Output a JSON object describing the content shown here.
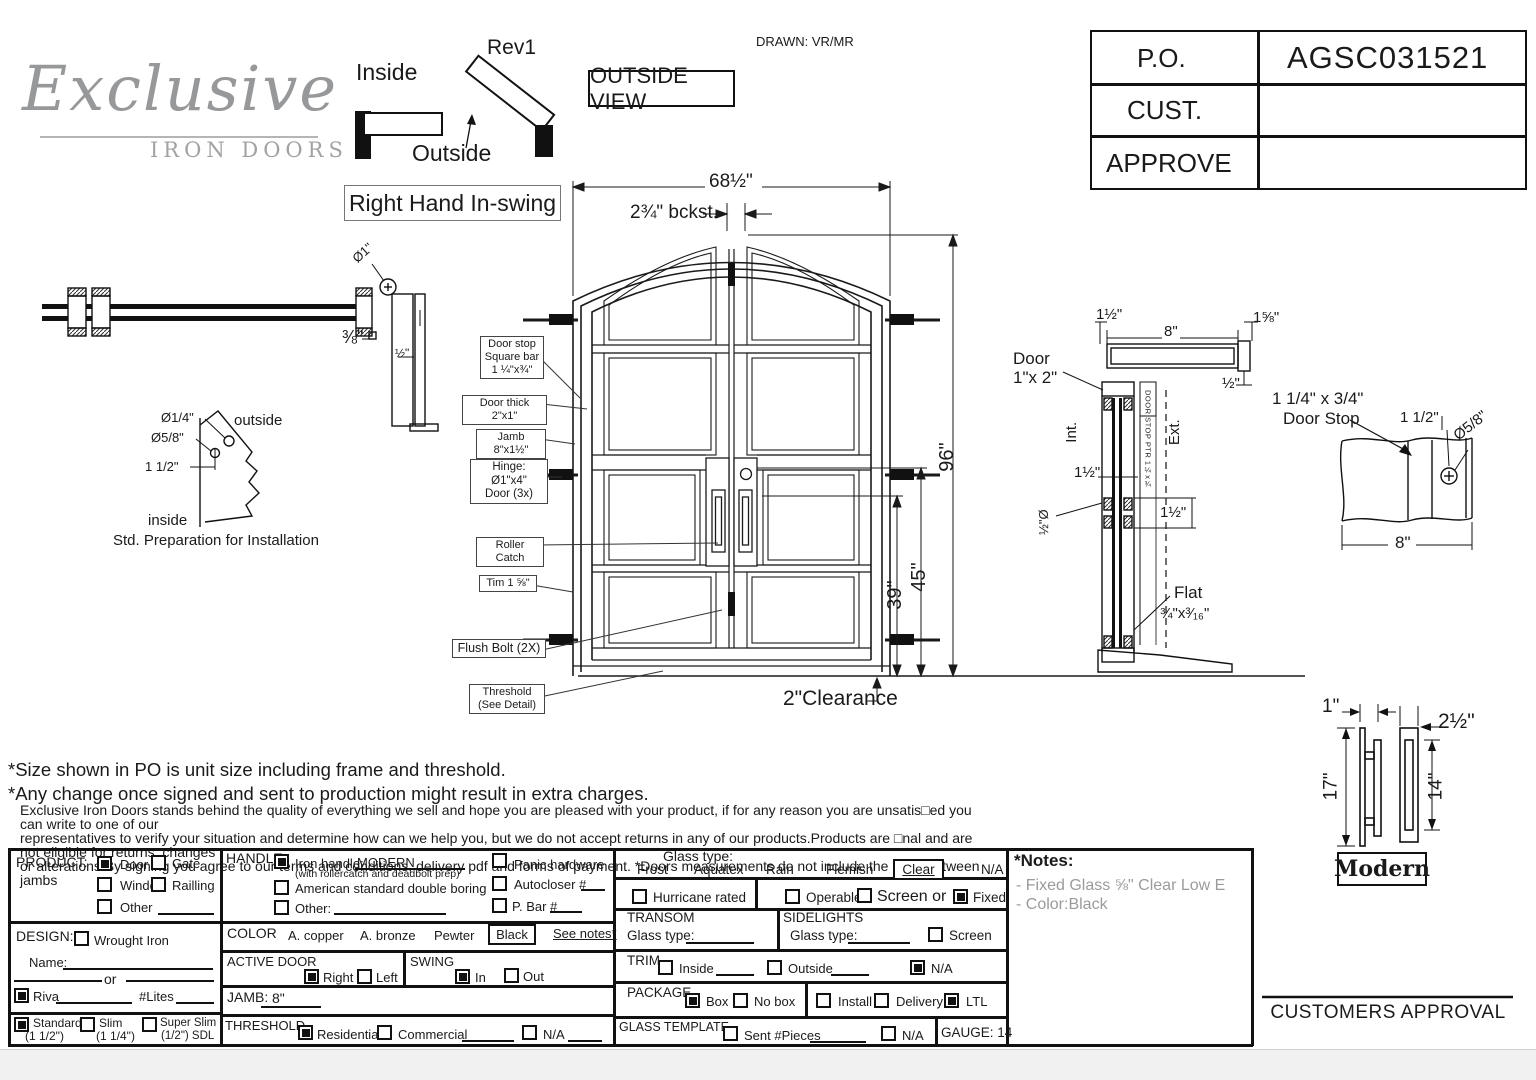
{
  "colors": {
    "line": "#1a1a1a",
    "form_line": "#111111",
    "gray_text": "#9b9b9b",
    "logo_gray": "#97989a",
    "bg": "#ffffff"
  },
  "meta": {
    "rev": "Rev1",
    "drawn": "DRAWN: VR/MR"
  },
  "logo": {
    "name": "Exclusive",
    "sub": "IRON DOORS"
  },
  "swing": {
    "inside": "Inside",
    "outside": "Outside",
    "outside_view": "OUTSIDE VIEW",
    "hand": "Right Hand In-swing"
  },
  "po": {
    "po_label": "P.O.",
    "po_value": "AGSC031521",
    "cust_label": "CUST.",
    "cust_value": "",
    "approve_label": "APPROVE",
    "approve_value": ""
  },
  "door": {
    "dim_width": "68½\"",
    "dim_backset": "2¾\" bckst.",
    "dim_height": "96\"",
    "dim_45": "45\"",
    "dim_39": "39\"",
    "dim_clearance": "2\"Clearance",
    "callout_doorstop": "Door stop\nSquare bar\n1 ¼\"x¾\"",
    "callout_thick": "Door thick 2\"x1\"",
    "callout_jamb": "Jamb 8\"x1½\"",
    "callout_hinge": "Hinge: Ø1\"x4\"\nDoor (3x)",
    "callout_roller": "Roller Catch",
    "callout_trim": "Tim 1 ⅝\"",
    "callout_flush": "Flush Bolt (2X)",
    "callout_threshold": "Threshold\n(See Detail)"
  },
  "head_section": {
    "dia": "Ø1\"",
    "d38": "⅜\"",
    "d12": "½\""
  },
  "prep": {
    "dia14": "Ø1/4\"",
    "dia58": "Ø5/8\"",
    "d112": "1 1/2\"",
    "outside": "outside",
    "inside": "inside",
    "caption": "Std. Preparation for Installation"
  },
  "jamb_section": {
    "d112_top": "1½\"",
    "d8": "8\"",
    "d158": "1⅝\"",
    "d12": "½\"",
    "door_size": "Door\n1\"x 2\"",
    "int": "Int.",
    "ext": "Ext.",
    "stop_ptr": "DOOR STOP PTR 1¼x¾",
    "d112_mid": "1½\"",
    "dia12": "½\"Ø",
    "d112_low": "1½\"",
    "flat": "Flat",
    "flat_size": "¾\"x³⁄₁₆\""
  },
  "stop_detail": {
    "size": "1 1/4\" x 3/4\"",
    "name": "Door Stop",
    "d112": "1 1/2\"",
    "dia58": "Ø5/8\"",
    "d8": "8\""
  },
  "handle_detail": {
    "d1": "1\"",
    "d212": "2½\"",
    "d17": "17\"",
    "d14": "14\"",
    "style": "Modern"
  },
  "notes_text": {
    "line1": "*Size shown in PO is unit size including frame and threshold.",
    "line2": "*Any change once signed and sent to production might result in extra charges.",
    "para": "Exclusive Iron Doors stands behind the quality of everything we sell and hope you are pleased with your product, if for any reason you are unsatis□ed you can write to one of our\nrepresentatives to verify your situation and determine how can we help you, but we do not accept returns in any of our products.Products are □nal and are not eligible for returns, changes\nor alterations.By signing you agree to our terms and conditions, delivery pdf and forms of payment. *Doors measurements do not include the gaps between jambs"
  },
  "form": {
    "product": {
      "label": "PRODUCT:",
      "door": {
        "label": "Door",
        "checked": true
      },
      "gate": {
        "label": "Gate",
        "checked": false
      },
      "window": {
        "label": "Window",
        "checked": false
      },
      "railing": {
        "label": "Railling",
        "checked": false
      },
      "other": {
        "label": "Other",
        "checked": false
      }
    },
    "design": {
      "label": "DESIGN:",
      "wrought": {
        "label": "Wrought Iron",
        "checked": false
      },
      "name_label": "Name:",
      "or": "or",
      "riva": {
        "label": "Riva",
        "checked": true
      },
      "lites_label": "#Lites",
      "standard": {
        "label": "Standard",
        "sub": "(1 1/2\")",
        "checked": true
      },
      "slim": {
        "label": "Slim",
        "sub": "(1 1/4\")",
        "checked": false
      },
      "superslim": {
        "label": "Super Slim",
        "sub": "(1/2\") SDL",
        "checked": false
      }
    },
    "handle": {
      "label": "HANDLE",
      "iron": {
        "label": "Iron handle:",
        "value": "MODERN",
        "sub": "(with rollercatch and deadbolt prep)",
        "checked": true
      },
      "american": {
        "label": "American standard double boring",
        "checked": false
      },
      "other": {
        "label": "Other:",
        "checked": false
      },
      "panic": {
        "label": "Panic hardware",
        "checked": false
      },
      "autocloser": {
        "label": "Autocloser #",
        "checked": false
      },
      "pbar": {
        "label": "P. Bar #",
        "checked": false
      }
    },
    "color": {
      "label": "COLOR",
      "opts": [
        "A. copper",
        "A. bronze",
        "Pewter"
      ],
      "selected": "Black",
      "see_notes": "See notes*"
    },
    "active_door": {
      "label": "ACTIVE DOOR",
      "right": {
        "label": "Right",
        "checked": true
      },
      "left": {
        "label": "Left",
        "checked": false
      }
    },
    "swing": {
      "label": "SWING",
      "sw_in": {
        "label": "In",
        "checked": true
      },
      "sw_out": {
        "label": "Out",
        "checked": false
      }
    },
    "jamb": {
      "label": "JAMB:",
      "value": "8\""
    },
    "threshold": {
      "label": "THRESHOLD",
      "residential": {
        "label": "Residential",
        "checked": true
      },
      "commercial": {
        "label": "Commercial",
        "checked": false
      },
      "na": {
        "label": "N/A",
        "checked": false
      }
    },
    "glass": {
      "label": "Glass type:",
      "opts": [
        "Frost",
        "Aquatex",
        "Rain",
        "Flemish"
      ],
      "selected": "Clear",
      "na": "N/A",
      "hurricane": {
        "label": "Hurricane rated",
        "checked": false
      },
      "operable": {
        "label": "Operable",
        "checked": false
      },
      "screen_or": {
        "label": "Screen or",
        "checked": false
      },
      "fixed": {
        "label": "Fixed",
        "checked": true
      }
    },
    "transom": {
      "label": "TRANSOM",
      "glass_label": "Glass type:"
    },
    "sidelights": {
      "label": "SIDELIGHTS",
      "glass_label": "Glass type:",
      "screen": {
        "label": "Screen",
        "checked": false
      }
    },
    "trim": {
      "label": "TRIM",
      "inside": {
        "label": "Inside",
        "checked": false
      },
      "outside": {
        "label": "Outside",
        "checked": false
      },
      "na": {
        "label": "N/A",
        "checked": true
      }
    },
    "package": {
      "label": "PACKAGE",
      "box": {
        "label": "Box",
        "checked": true
      },
      "nobox": {
        "label": "No box",
        "checked": false
      },
      "install": {
        "label": "Install",
        "checked": false
      },
      "delivery": {
        "label": "Delivery",
        "checked": false
      },
      "ltl": {
        "label": "LTL",
        "checked": true
      }
    },
    "glass_template": {
      "label": "GLASS TEMPLATE",
      "sent": {
        "label": "Sent #Pieces",
        "checked": false
      },
      "na": {
        "label": "N/A",
        "checked": false
      },
      "gauge": "GAUGE: 14"
    }
  },
  "notes_box": {
    "title": "*Notes:",
    "line1": "- Fixed Glass ⅝\" Clear  Low E",
    "line2": "- Color:Black"
  },
  "approval": {
    "label": "CUSTOMERS APPROVAL"
  }
}
